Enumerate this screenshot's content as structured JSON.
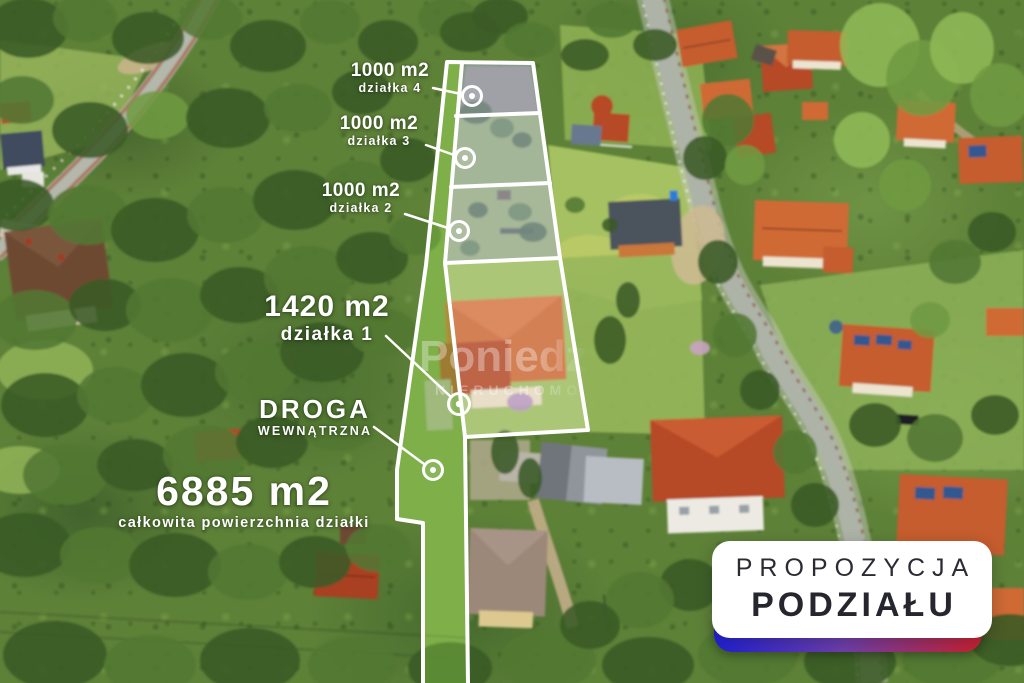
{
  "overlay": {
    "parcels": [
      {
        "area": "1000 m2",
        "name": "działka 4"
      },
      {
        "area": "1000 m2",
        "name": "działka 3"
      },
      {
        "area": "1000 m2",
        "name": "działka 2"
      },
      {
        "area": "1420 m2",
        "name": "działka 1"
      }
    ],
    "road": {
      "line1": "DROGA",
      "line2": "WEWNĄTRZNA"
    },
    "total": {
      "area": "6885 m2",
      "caption": "całkowita powierzchnia działki"
    }
  },
  "badge": {
    "line1": "PROPOZYCJA",
    "line2": "PODZIAŁU"
  },
  "watermark": {
    "line1": "Poniedzi",
    "line2": "NIERUCHOMO"
  },
  "colors": {
    "badge_gradient_left": "#2020d8",
    "badge_gradient_right": "#cd2030",
    "parcel_tint": "#aab4cf",
    "road_tint": "#7fc242",
    "outline": "#ffffff"
  }
}
